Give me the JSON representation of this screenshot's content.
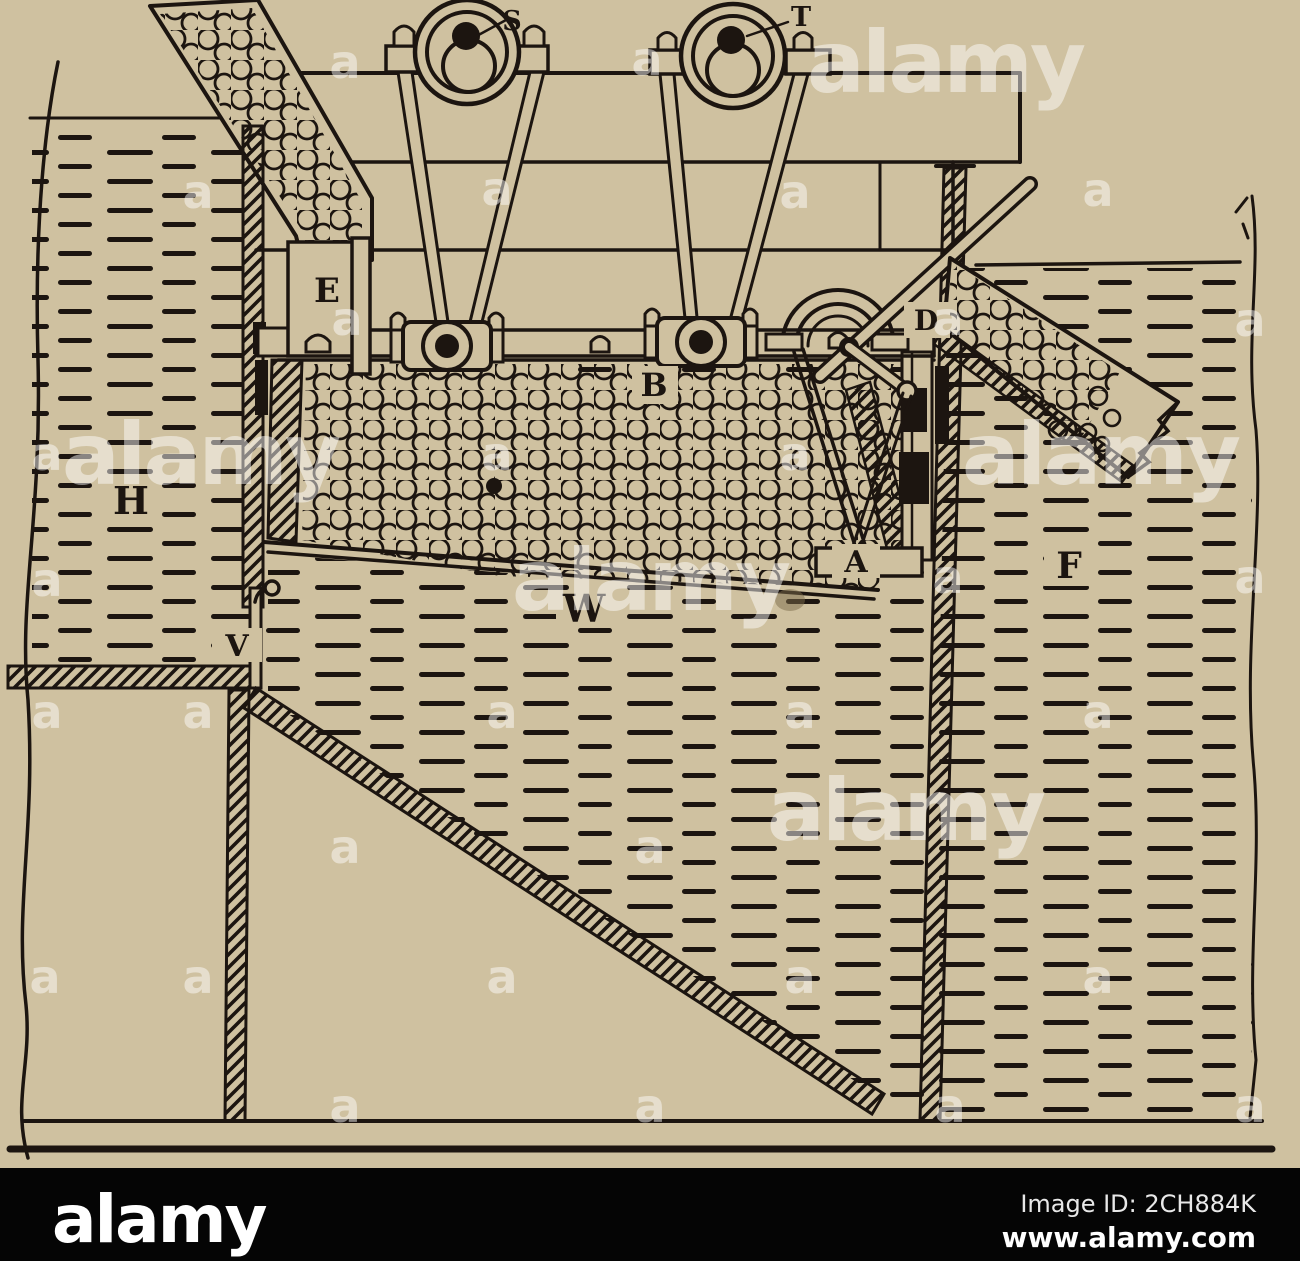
{
  "figure": {
    "labels": {
      "S": "S",
      "T": "T",
      "E": "E",
      "B": "B",
      "D": "D",
      "H": "H",
      "V": "V",
      "W": "W",
      "A": "A",
      "F": "F"
    }
  },
  "watermark": {
    "big_text": "alamy",
    "small_text": "a",
    "big_positions": [
      [
        945,
        92
      ],
      [
        200,
        484
      ],
      [
        1100,
        484
      ],
      [
        650,
        610
      ],
      [
        905,
        840
      ]
    ],
    "small_positions": [
      [
        345,
        78
      ],
      [
        647,
        75
      ],
      [
        198,
        208
      ],
      [
        497,
        205
      ],
      [
        795,
        208
      ],
      [
        1098,
        206
      ],
      [
        347,
        335
      ],
      [
        948,
        335
      ],
      [
        1250,
        336
      ],
      [
        47,
        470
      ],
      [
        497,
        470
      ],
      [
        795,
        470
      ],
      [
        47,
        596
      ],
      [
        948,
        593
      ],
      [
        1250,
        593
      ],
      [
        47,
        728
      ],
      [
        198,
        728
      ],
      [
        502,
        728
      ],
      [
        800,
        728
      ],
      [
        1098,
        728
      ],
      [
        345,
        863
      ],
      [
        650,
        863
      ],
      [
        45,
        993
      ],
      [
        198,
        993
      ],
      [
        502,
        993
      ],
      [
        800,
        993
      ],
      [
        1098,
        993
      ],
      [
        345,
        1122
      ],
      [
        650,
        1122
      ],
      [
        950,
        1122
      ],
      [
        1250,
        1122
      ]
    ]
  },
  "footer": {
    "logo": "alamy",
    "image_id": "Image ID: 2CH884K",
    "url": "www.alamy.com"
  },
  "colors": {
    "paper": "#cfc1a0",
    "ink": "#1c1510",
    "bottom_bar": "#050505",
    "watermark": "#ffffff",
    "stain": "#7b6b4a"
  }
}
